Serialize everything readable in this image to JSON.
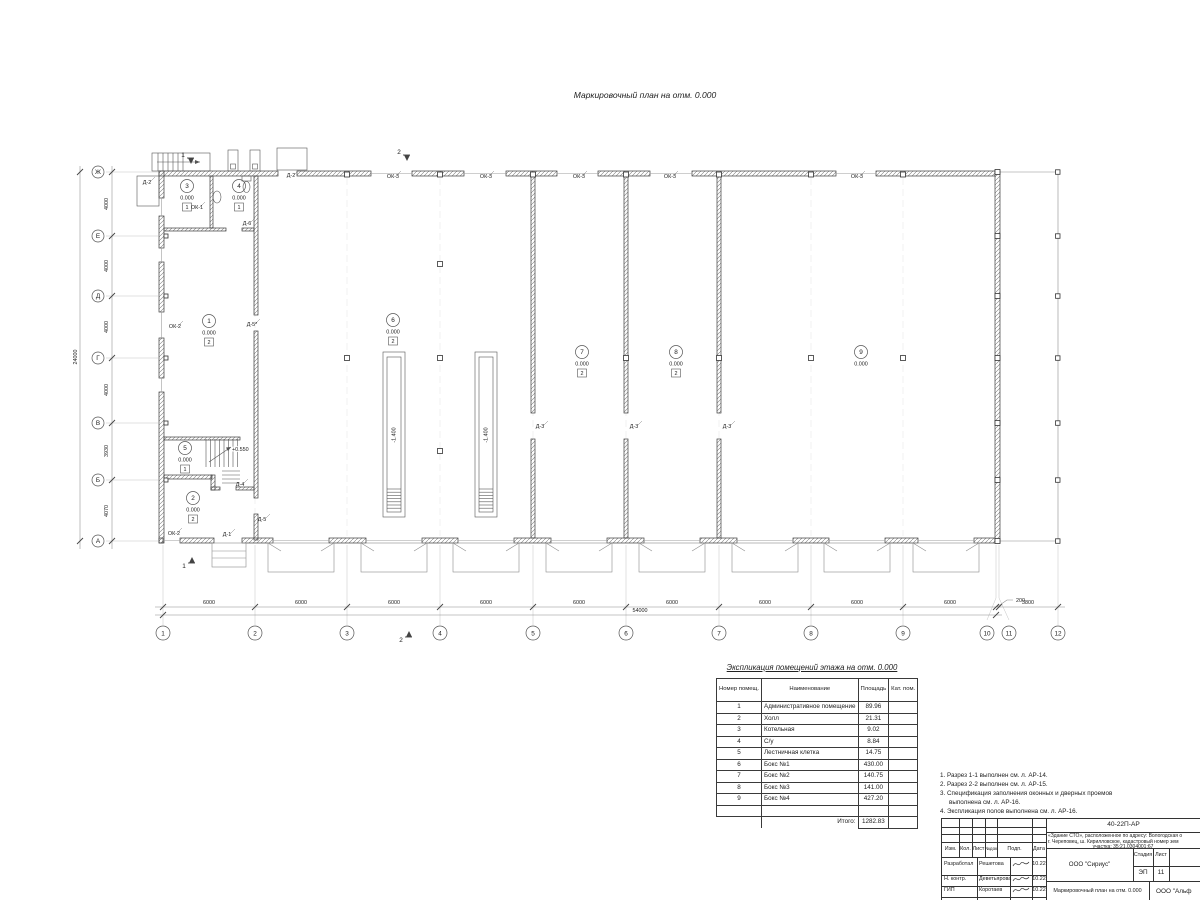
{
  "colors": {
    "wall_line": "#3c3c3c",
    "hatch": "#7a7a7a",
    "dim_line": "#8a8a8a",
    "text": "#222222",
    "faint": "#c4c4c4"
  },
  "sheet_title": "Маркировочный план на отм. 0.000",
  "plan": {
    "grid_rows": [
      {
        "label": "Ж",
        "y": 172
      },
      {
        "label": "Е",
        "y": 236
      },
      {
        "label": "Д",
        "y": 296
      },
      {
        "label": "Г",
        "y": 358
      },
      {
        "label": "В",
        "y": 423
      },
      {
        "label": "Б",
        "y": 480
      },
      {
        "label": "А",
        "y": 541
      }
    ],
    "grid_cols": [
      {
        "label": "1",
        "axis": 163,
        "cx": 163
      },
      {
        "label": "2",
        "axis": 255,
        "cx": 255
      },
      {
        "label": "3",
        "axis": 347,
        "cx": 347
      },
      {
        "label": "4",
        "axis": 440,
        "cx": 440
      },
      {
        "label": "5",
        "axis": 533,
        "cx": 533
      },
      {
        "label": "6",
        "axis": 626,
        "cx": 626
      },
      {
        "label": "7",
        "axis": 719,
        "cx": 719
      },
      {
        "label": "8",
        "axis": 811,
        "cx": 811
      },
      {
        "label": "9",
        "axis": 903,
        "cx": 903
      },
      {
        "label": "10",
        "axis": 996,
        "cx": 987
      },
      {
        "label": "11",
        "axis": 999,
        "cx": 1009
      },
      {
        "label": "12",
        "axis": 1058,
        "cx": 1058
      }
    ],
    "row_dims": [
      {
        "text": "4000",
        "y": 204
      },
      {
        "text": "4000",
        "y": 266
      },
      {
        "text": "4000",
        "y": 327
      },
      {
        "text": "4000",
        "y": 390
      },
      {
        "text": "3930",
        "y": 451
      },
      {
        "text": "4070",
        "y": 511
      }
    ],
    "col_dims": [
      {
        "text": "6000",
        "x": 209
      },
      {
        "text": "6000",
        "x": 301
      },
      {
        "text": "6000",
        "x": 394
      },
      {
        "text": "6000",
        "x": 486
      },
      {
        "text": "6000",
        "x": 579
      },
      {
        "text": "6000",
        "x": 672
      },
      {
        "text": "6000",
        "x": 765
      },
      {
        "text": "6000",
        "x": 857
      },
      {
        "text": "6000",
        "x": 950
      },
      {
        "text": "3800",
        "x": 1028
      }
    ],
    "dim_200": {
      "text": "200",
      "x": 1016,
      "y": 602
    },
    "overall_v": {
      "text": "24000",
      "x": 77,
      "y": 357
    },
    "overall_h": {
      "text": "54000",
      "x": 640,
      "y": 612
    },
    "rooms": [
      {
        "n": "1",
        "x": 209,
        "y": 321,
        "elev": "0.000",
        "type": "2"
      },
      {
        "n": "2",
        "x": 193,
        "y": 498,
        "elev": "0.000",
        "type": "2"
      },
      {
        "n": "3",
        "x": 187,
        "y": 186,
        "elev": "0.000",
        "type": "1"
      },
      {
        "n": "4",
        "x": 239,
        "y": 186,
        "elev": "0.000",
        "type": "1"
      },
      {
        "n": "5",
        "x": 185,
        "y": 448,
        "elev": "0.000",
        "type": "1"
      },
      {
        "n": "6",
        "x": 393,
        "y": 320,
        "elev": "0.000",
        "type": "2"
      },
      {
        "n": "7",
        "x": 582,
        "y": 352,
        "elev": "0.000",
        "type": "2"
      },
      {
        "n": "8",
        "x": 676,
        "y": 352,
        "elev": "0.000",
        "type": "2"
      },
      {
        "n": "9",
        "x": 861,
        "y": 352,
        "elev": "0.000",
        "type": ""
      }
    ],
    "openings": [
      {
        "t": "Д-2",
        "x": 147,
        "y": 184
      },
      {
        "t": "Д-2",
        "x": 291,
        "y": 177
      },
      {
        "t": "ОК-1",
        "x": 197,
        "y": 209
      },
      {
        "t": "ОК-2",
        "x": 175,
        "y": 328
      },
      {
        "t": "ОК-2",
        "x": 174,
        "y": 535
      },
      {
        "t": "Д-1",
        "x": 227,
        "y": 536
      },
      {
        "t": "Д-6",
        "x": 247,
        "y": 225
      },
      {
        "t": "Д-5*",
        "x": 252,
        "y": 326
      },
      {
        "t": "Д-4",
        "x": 240,
        "y": 486
      },
      {
        "t": "Д-5",
        "x": 262,
        "y": 521
      },
      {
        "t": "Д-3",
        "x": 540,
        "y": 428
      },
      {
        "t": "Д-3",
        "x": 634,
        "y": 428
      },
      {
        "t": "Д-3",
        "x": 727,
        "y": 428
      },
      {
        "t": "ОК-3",
        "x": 393,
        "y": 178
      },
      {
        "t": "ОК-3",
        "x": 486,
        "y": 178
      },
      {
        "t": "ОК-3",
        "x": 579,
        "y": 178
      },
      {
        "t": "ОК-3",
        "x": 670,
        "y": 178
      },
      {
        "t": "ОК-3",
        "x": 857,
        "y": 178
      }
    ],
    "pits": [
      {
        "label": "-1.400",
        "x": 394
      },
      {
        "label": "-1.400",
        "x": 486
      }
    ],
    "stair_note": "+0.550",
    "sections": [
      {
        "label": "1",
        "x": 183,
        "y": 155,
        "dir": "down"
      },
      {
        "label": "2",
        "x": 399,
        "y": 152,
        "dir": "down"
      },
      {
        "label": "1",
        "x": 184,
        "y": 566,
        "dir": "up"
      },
      {
        "label": "2",
        "x": 401,
        "y": 640,
        "dir": "up"
      }
    ],
    "columns": {
      "top": [
        347,
        440,
        533,
        626,
        719,
        811,
        903
      ],
      "mid": [
        [
          347,
          358
        ],
        [
          440,
          358
        ],
        [
          626,
          358
        ],
        [
          719,
          358
        ],
        [
          811,
          358
        ],
        [
          903,
          358
        ],
        [
          440,
          264
        ],
        [
          440,
          451
        ]
      ],
      "left": [
        236,
        296,
        358,
        423,
        480
      ],
      "right": [
        172,
        236,
        296,
        358,
        423,
        480,
        541
      ],
      "canopy": [
        172,
        236,
        296,
        358,
        423,
        480,
        541
      ]
    },
    "gates": [
      301,
      394,
      486,
      579,
      672,
      765,
      857,
      946
    ]
  },
  "explication": {
    "title": "Экспликация помещений этажа на отм. 0.000",
    "col1": "Номер помещ.",
    "col2": "Наименование",
    "col3": "Площадь",
    "col4": "Кат. пом.",
    "rows": [
      [
        "1",
        "Административное помещение",
        "89.96"
      ],
      [
        "2",
        "Холл",
        "21.31"
      ],
      [
        "3",
        "Котельная",
        "9.02"
      ],
      [
        "4",
        "С/у",
        "8.84"
      ],
      [
        "5",
        "Лестничная клетка",
        "14.75"
      ],
      [
        "6",
        "Бокс №1",
        "430.00"
      ],
      [
        "7",
        "Бокс №2",
        "140.75"
      ],
      [
        "8",
        "Бокс №3",
        "141.00"
      ],
      [
        "9",
        "Бокс №4",
        "427.20"
      ]
    ],
    "total_label": "Итого:",
    "total_value": "1282.83"
  },
  "notes": [
    "1. Разрез 1-1 выполнен см. л. АР-14.",
    "2. Разрез 2-2 выполнен см. л. АР-15.",
    "3. Спецификация заполнения оконных и дверных проемов выполнена см. л. АР-16.",
    "4. Экспликация полов выполнена см. л. АР-16."
  ],
  "titleblock": {
    "doc_number": "40-22П-АР",
    "project_line1": "«Здание СТО», расположенное по адресу: Вологодская о",
    "project_line2": "г. Череповец, ш. Кирилловское, кадастровый номер зем",
    "project_line3": "участка: 35:21.0304001:67",
    "org": "ООО \"Сириус\"",
    "stage_label": "Стадия",
    "sheet_label": "Лист",
    "stage_value": "ЭП",
    "sheet_value": "11",
    "drawing_name": "Маркировочный план на отм. 0.000",
    "org2": "ООО \"Альф",
    "header_cols": [
      "Изм.",
      "Кол.",
      "Лист",
      "№док",
      "Подп.",
      "Дата"
    ],
    "people": [
      {
        "role": "Разработал",
        "name": "Решетова",
        "date": "10.22"
      },
      {
        "role": "Н. контр.",
        "name": "Деветьярова",
        "date": "10.22"
      },
      {
        "role": "ГИП",
        "name": "Коротаев",
        "date": "10.22"
      }
    ]
  }
}
